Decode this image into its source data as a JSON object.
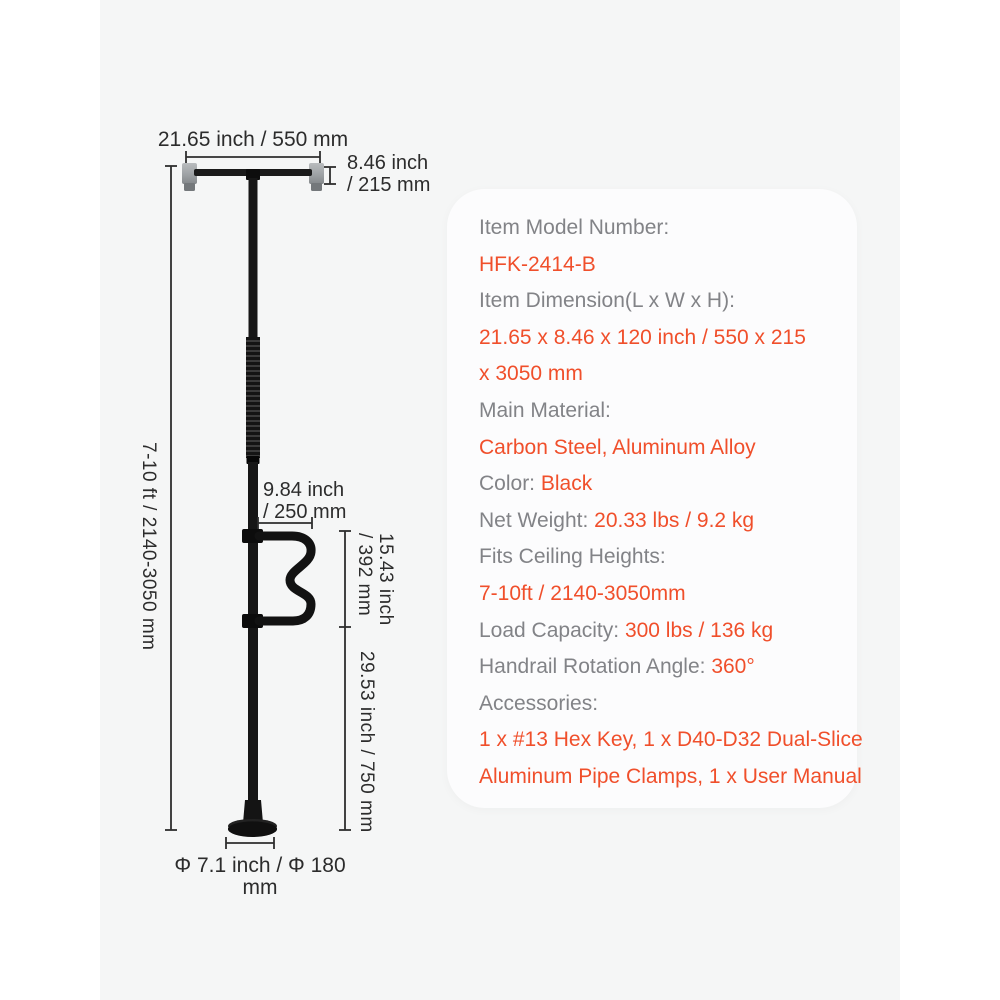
{
  "colors": {
    "accent_orange": "#F04F2B",
    "label_gray": "#828387",
    "drawing_ink": "#2C2C2C",
    "stage_background": "#F5F6F6",
    "panel_background": "#FCFCFD",
    "product_black": "#141414",
    "ceiling_pad_gray": "#A6AAAD"
  },
  "drawing": {
    "dim_top_width": "21.65 inch / 550 mm",
    "dim_top_depth": "8.46 inch\n/ 215 mm",
    "dim_total_height": "7-10 ft / 2140-3050 mm",
    "dim_handle_length": "9.84 inch\n/ 250 mm",
    "dim_handle_height": "15.43 inch\n/ 392 mm",
    "dim_lower_height": "29.53 inch / 750 mm",
    "dim_base_diameter": "Φ 7.1 inch / Φ 180 mm"
  },
  "panel": {
    "lines": [
      {
        "label": "Item Model Number:"
      },
      {
        "value": "HFK-2414-B"
      },
      {
        "label": "Item Dimension(L x W x H):"
      },
      {
        "value": "21.65 x 8.46 x 120 inch / 550 x 215"
      },
      {
        "value": "x 3050 mm"
      },
      {
        "label": "Main Material:"
      },
      {
        "value": "Carbon Steel, Aluminum Alloy"
      },
      {
        "label": "Color: ",
        "value": "Black"
      },
      {
        "label": "Net Weight:",
        "value": "20.33 lbs / 9.2 kg"
      },
      {
        "label": "Fits Ceiling Heights:"
      },
      {
        "value": "7-10ft / 2140-3050mm"
      },
      {
        "label": "Load Capacity:",
        "value": "300 lbs / 136 kg"
      },
      {
        "label": "Handrail Rotation Angle:",
        "value": "360°"
      },
      {
        "label": "Accessories:"
      },
      {
        "value": "1 x #13 Hex Key, 1 x D40-D32 Dual-Slice"
      },
      {
        "value": "Aluminum Pipe Clamps, 1 x User Manual"
      }
    ]
  }
}
